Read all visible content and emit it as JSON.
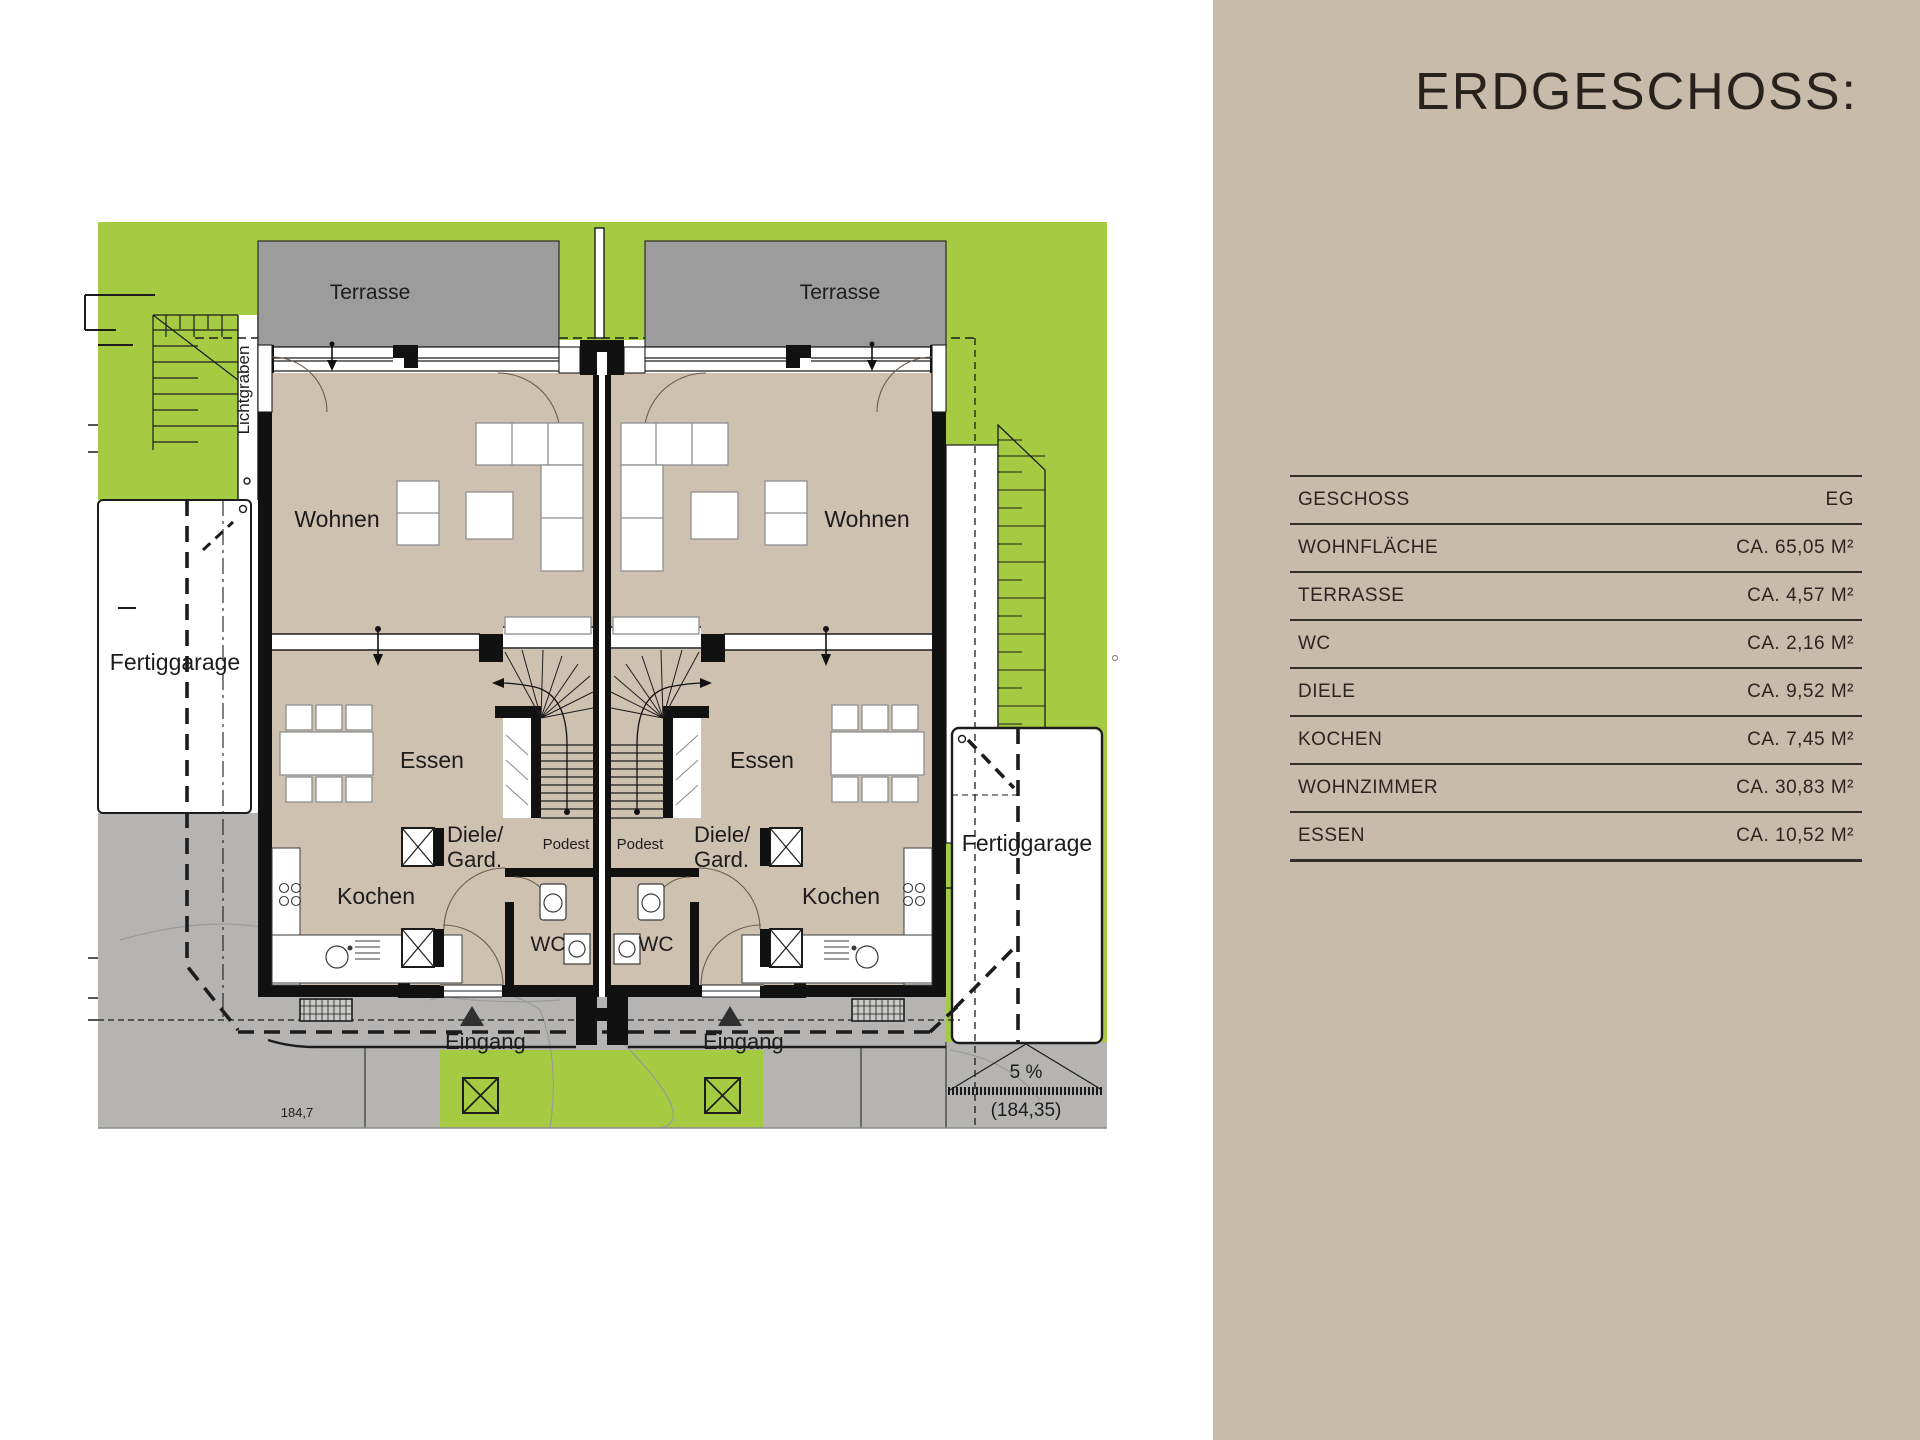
{
  "panel": {
    "title": "ERDGESCHOSS:",
    "table": {
      "rows": [
        {
          "label": "GESCHOSS",
          "value": "EG"
        },
        {
          "label": "WOHNFLÄCHE",
          "value": "CA. 65,05 M²"
        },
        {
          "label": "TERRASSE",
          "value": "CA. 4,57 M²"
        },
        {
          "label": "WC",
          "value": "CA. 2,16 M²"
        },
        {
          "label": "DIELE",
          "value": "CA. 9,52 M²"
        },
        {
          "label": "KOCHEN",
          "value": "CA. 7,45 M²"
        },
        {
          "label": "WOHNZIMMER",
          "value": "CA. 30,83 M²"
        },
        {
          "label": "ESSEN",
          "value": "CA. 10,52 M²"
        }
      ]
    }
  },
  "plan": {
    "labels": {
      "terrasse": "Terrasse",
      "wohnen": "Wohnen",
      "essen": "Essen",
      "kochen": "Kochen",
      "diele_line1": "Diele/",
      "diele_line2": "Gard.",
      "wc": "WC",
      "podest": "Podest",
      "eingang": "Eingang",
      "fertiggarage": "Fertiggarage",
      "lichtgraben": "Lichtgraben",
      "slope_percent": "5 %",
      "level_value": "(184,35)",
      "ground_level": "184,7"
    },
    "colors": {
      "lawn_green": "#a4cb41",
      "floor_beige": "#cfc1b0",
      "terrace_gray": "#9c9c9c",
      "pavement_gray": "#b5b4b2",
      "panel_beige": "#c8bbaa"
    }
  }
}
